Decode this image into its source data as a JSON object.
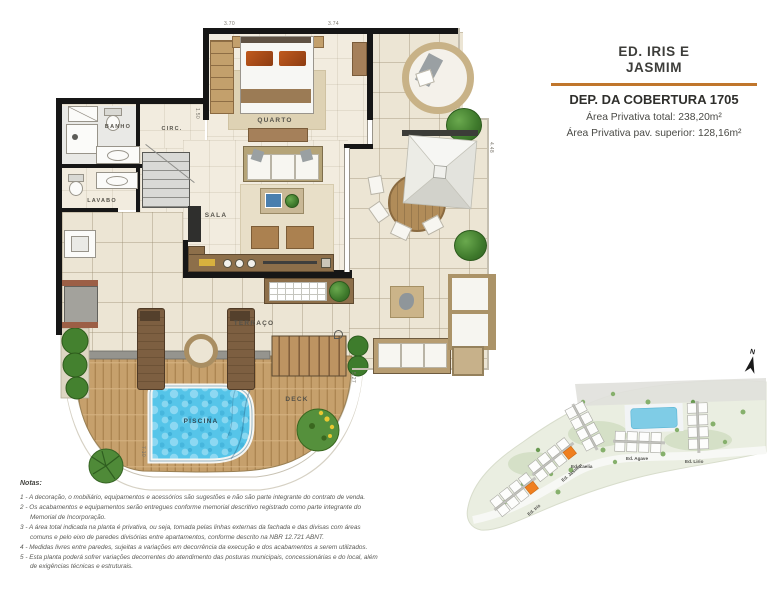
{
  "title_block": {
    "building_name_line1": "ED. IRIS E",
    "building_name_line2": "JASMIM",
    "unit_title": "DEP. DA COBERTURA 1705",
    "area_total": "Área Privativa total: 238,20m²",
    "area_upper": "Área Privativa pav. superior: 128,16m²"
  },
  "floor_plan": {
    "rooms": {
      "quarto": "QUARTO",
      "banho": "BANHO",
      "circ": "CIRC.",
      "lavabo": "LAVABO",
      "sala": "SALA",
      "terraco": "TERRAÇO",
      "deck": "DECK",
      "piscina": "PISCINA"
    },
    "dimensions": {
      "top_left": "3.70",
      "top_right": "3.74",
      "right": "4.48",
      "deck_right": "5.27",
      "pool_left": "7.10",
      "quarto_left": "1.50"
    }
  },
  "site_plan": {
    "north_label": "N",
    "buildings": [
      {
        "label": "Ed. Iris"
      },
      {
        "label": "Ed. Jasmim"
      },
      {
        "label": "Ed. Laelia"
      },
      {
        "label": "Ed. Agave"
      },
      {
        "label": "Ed. Lirio"
      }
    ]
  },
  "notes": {
    "heading": "Notas:",
    "items": [
      "1 - A decoração, o mobiliário, equipamentos e acessórios são sugestões e não são parte integrante do contrato de venda.",
      "2 - Os acabamentos e equipamentos serão entregues conforme memorial descritivo registrado como parte integrante do Memorial de Incorporação.",
      "3 - A área total indicada na planta é privativa, ou seja, tomada pelas linhas externas da fachada e das divisas com áreas comuns e pelo eixo de paredes divisórias entre apartamentos, conforme descrito na NBR 12.721 ABNT.",
      "4 - Medidas livres entre paredes, sujeitas a variações em decorrência da execução e dos acabamentos a serem utilizados.",
      "5 - Esta planta poderá sofrer variações decorrentes do atendimento das posturas municipais, concessionárias e do local, além de exigências técnicas e estruturais."
    ]
  },
  "colors": {
    "accent": "#c0762c",
    "highlight_unit": "#ef7f1f",
    "wall": "#161616",
    "pool_water": "#56c5e9",
    "deck_wood": "#c6a06c",
    "terrace_floor": "#ece5d4"
  }
}
